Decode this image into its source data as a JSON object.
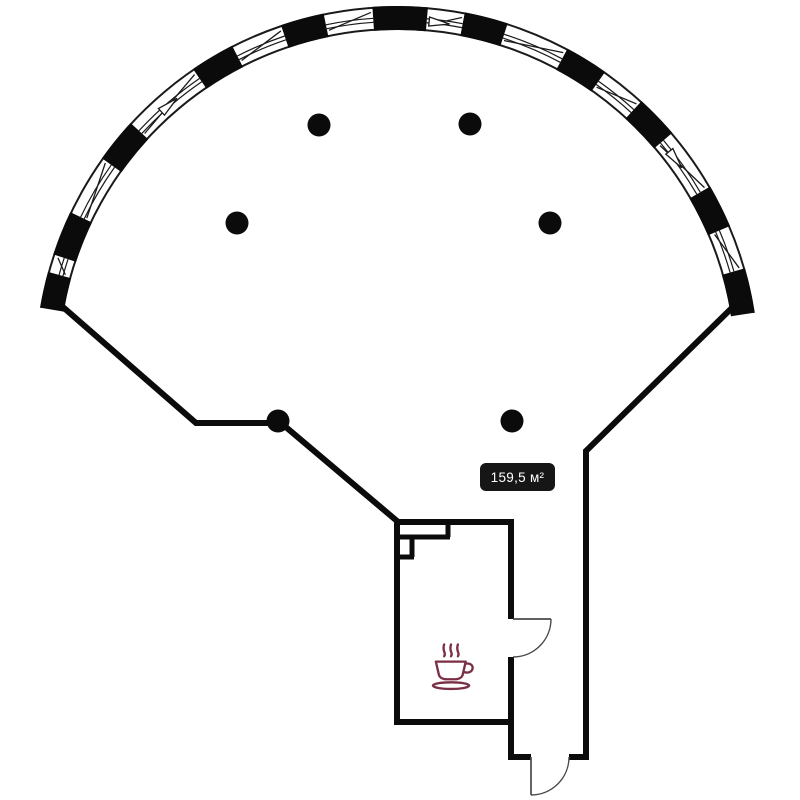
{
  "plan": {
    "canvas": {
      "width": 800,
      "height": 800,
      "background": "#ffffff"
    },
    "colors": {
      "wall": "#0b0b0b",
      "door": "#4a4a4a",
      "glazing": "#1a1a1a",
      "badge_bg": "#161616",
      "badge_fg": "#ffffff",
      "coffee": "#7b2f45"
    },
    "area_badge": {
      "text": "159,5 м²",
      "x": 480,
      "y": 463,
      "width": 75,
      "height": 28,
      "radius": 6
    },
    "coffee_icon": {
      "name": "coffee-cup-icon",
      "x": 429,
      "y": 639,
      "width": 47,
      "height": 58
    },
    "columns": {
      "radius": 11.5,
      "centers": [
        [
          319,
          125
        ],
        [
          470,
          124
        ],
        [
          237,
          223
        ],
        [
          550,
          223
        ],
        [
          278,
          421
        ],
        [
          512,
          421
        ]
      ]
    },
    "facade_arc": {
      "cx": 397,
      "cy": 368,
      "r_outer": 361,
      "r_inner": 339,
      "r_mid": 350,
      "start_deg": 189.6,
      "end_deg": 351.2,
      "piers_deg": [
        [
          189.6,
          195.4
        ],
        [
          198.3,
          205.5
        ],
        [
          215.4,
          222.6
        ],
        [
          235.7,
          242.9
        ],
        [
          251.3,
          258.3
        ],
        [
          266.1,
          274.9
        ],
        [
          280.8,
          287.8
        ],
        [
          298.1,
          305.1
        ],
        [
          312.5,
          319.5
        ],
        [
          329.9,
          336.9
        ],
        [
          344.0,
          351.2
        ]
      ],
      "vent_arrows_deg": [
        228.7,
        276.6,
        322.8
      ]
    },
    "walls": {
      "thickness": 6,
      "polylines": [
        [
          [
            56,
            301
          ],
          [
            196,
            423
          ],
          [
            281,
            423
          ],
          [
            397,
            521
          ],
          [
            397,
            722
          ],
          [
            514,
            722
          ]
        ],
        [
          [
            394,
            522
          ],
          [
            514,
            522
          ]
        ],
        [
          [
            511,
            520
          ],
          [
            511,
            619
          ]
        ],
        [
          [
            511,
            657
          ],
          [
            511,
            757
          ],
          [
            531,
            757
          ]
        ],
        [
          [
            741,
            299
          ],
          [
            586,
            451
          ],
          [
            586,
            757
          ],
          [
            569,
            757
          ]
        ]
      ],
      "inner_thickness": 5,
      "inner_polylines": [
        [
          [
            448,
            523
          ],
          [
            448,
            537
          ]
        ],
        [
          [
            396,
            537
          ],
          [
            450,
            537
          ]
        ],
        [
          [
            412,
            537
          ],
          [
            412,
            557
          ]
        ],
        [
          [
            396,
            557
          ],
          [
            414,
            557
          ]
        ]
      ]
    },
    "doors": [
      {
        "leaf": [
          [
            513,
            619
          ],
          [
            551,
            619
          ]
        ],
        "arc": {
          "from": [
            551,
            619
          ],
          "to": [
            513,
            657
          ],
          "r": 38
        }
      },
      {
        "leaf": [
          [
            531,
            757
          ],
          [
            531,
            795
          ]
        ],
        "arc": {
          "from": [
            569,
            757
          ],
          "to": [
            531,
            795
          ],
          "r": 38
        }
      }
    ]
  }
}
